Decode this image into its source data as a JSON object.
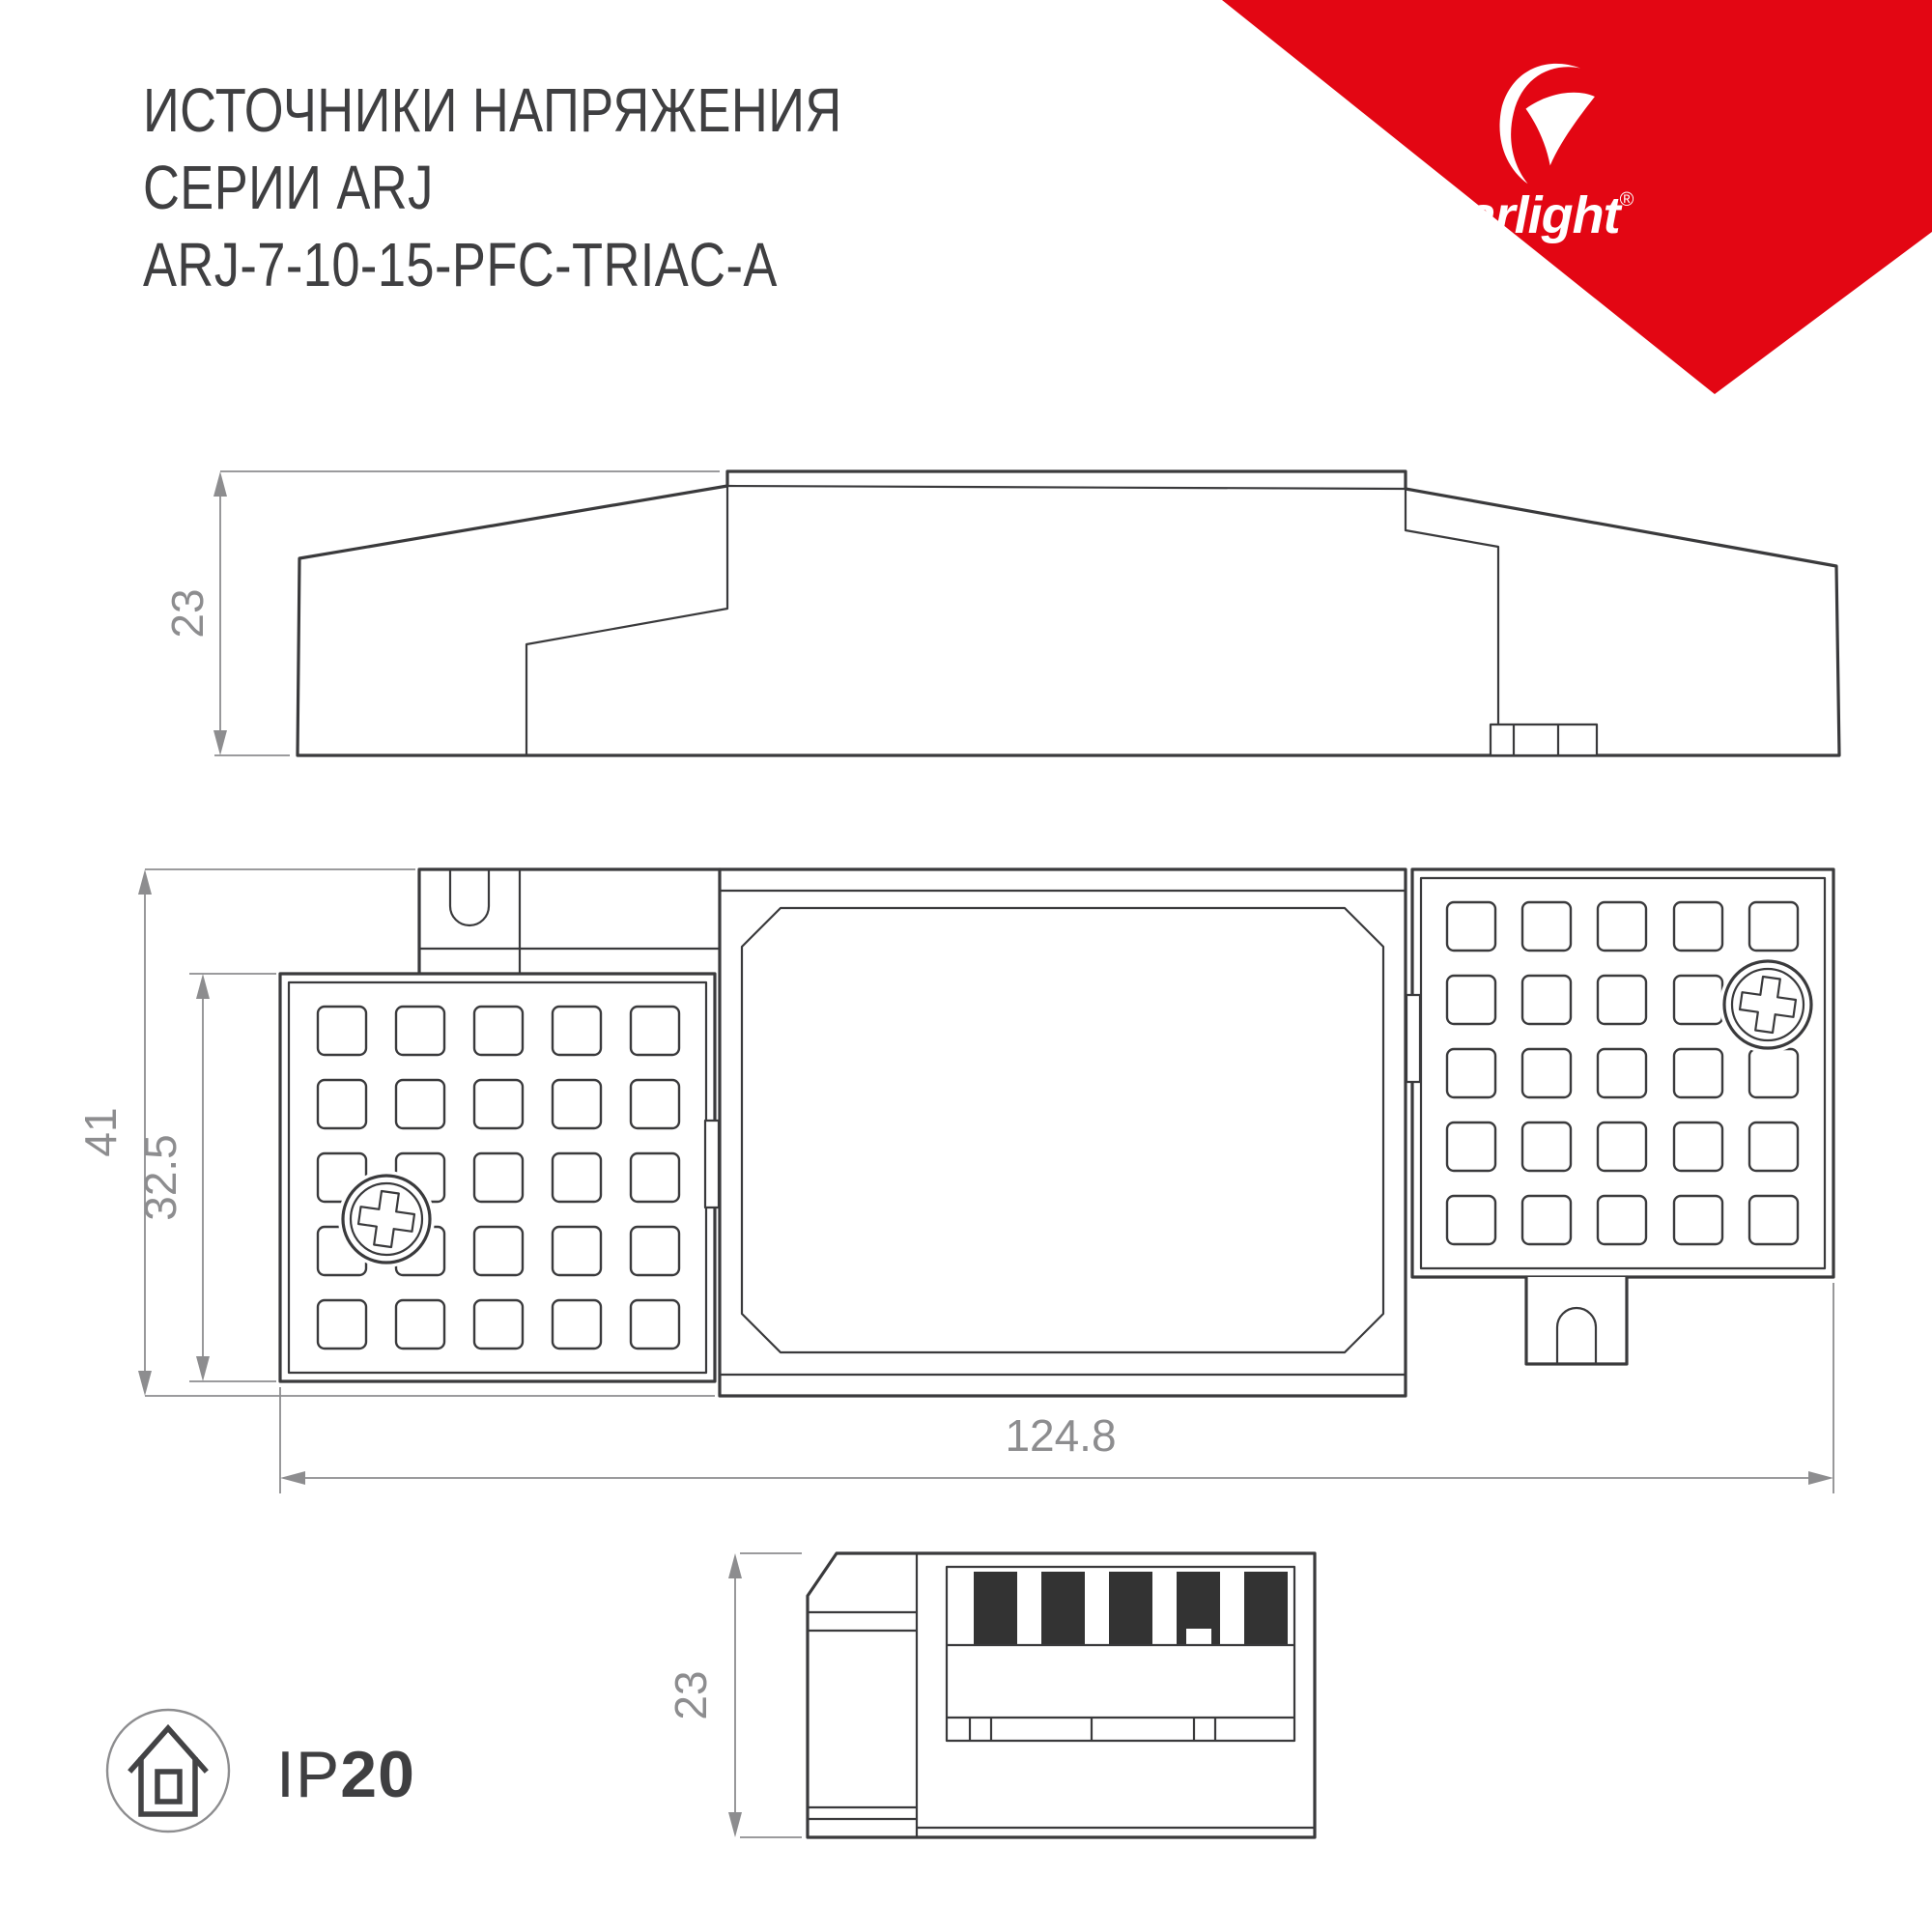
{
  "header": {
    "line1": "ИСТОЧНИКИ НАПРЯЖЕНИЯ",
    "line2": "СЕРИИ ARJ",
    "line3": "ARJ-7-10-15-PFC-TRIAC-A"
  },
  "logo": {
    "brand": "arlight",
    "registered": "®",
    "icon": "arlight-swoosh-icon"
  },
  "colors": {
    "brand_red": "#e30613",
    "line_dark": "#3a3a3c",
    "dim_gray": "#8d8d8f",
    "title_text": "#3f3f41",
    "terminal_black": "#333333"
  },
  "views": {
    "side": {
      "label": "side-profile-view",
      "height_dim": "23"
    },
    "top": {
      "label": "top-view",
      "height_dim": "41",
      "panel_dim": "32.5",
      "length_dim": "124.8"
    },
    "end": {
      "label": "end-view",
      "height_dim": "23"
    }
  },
  "ip_badge": {
    "prefix": "IP",
    "rating": "20",
    "icon": "house-icon"
  }
}
